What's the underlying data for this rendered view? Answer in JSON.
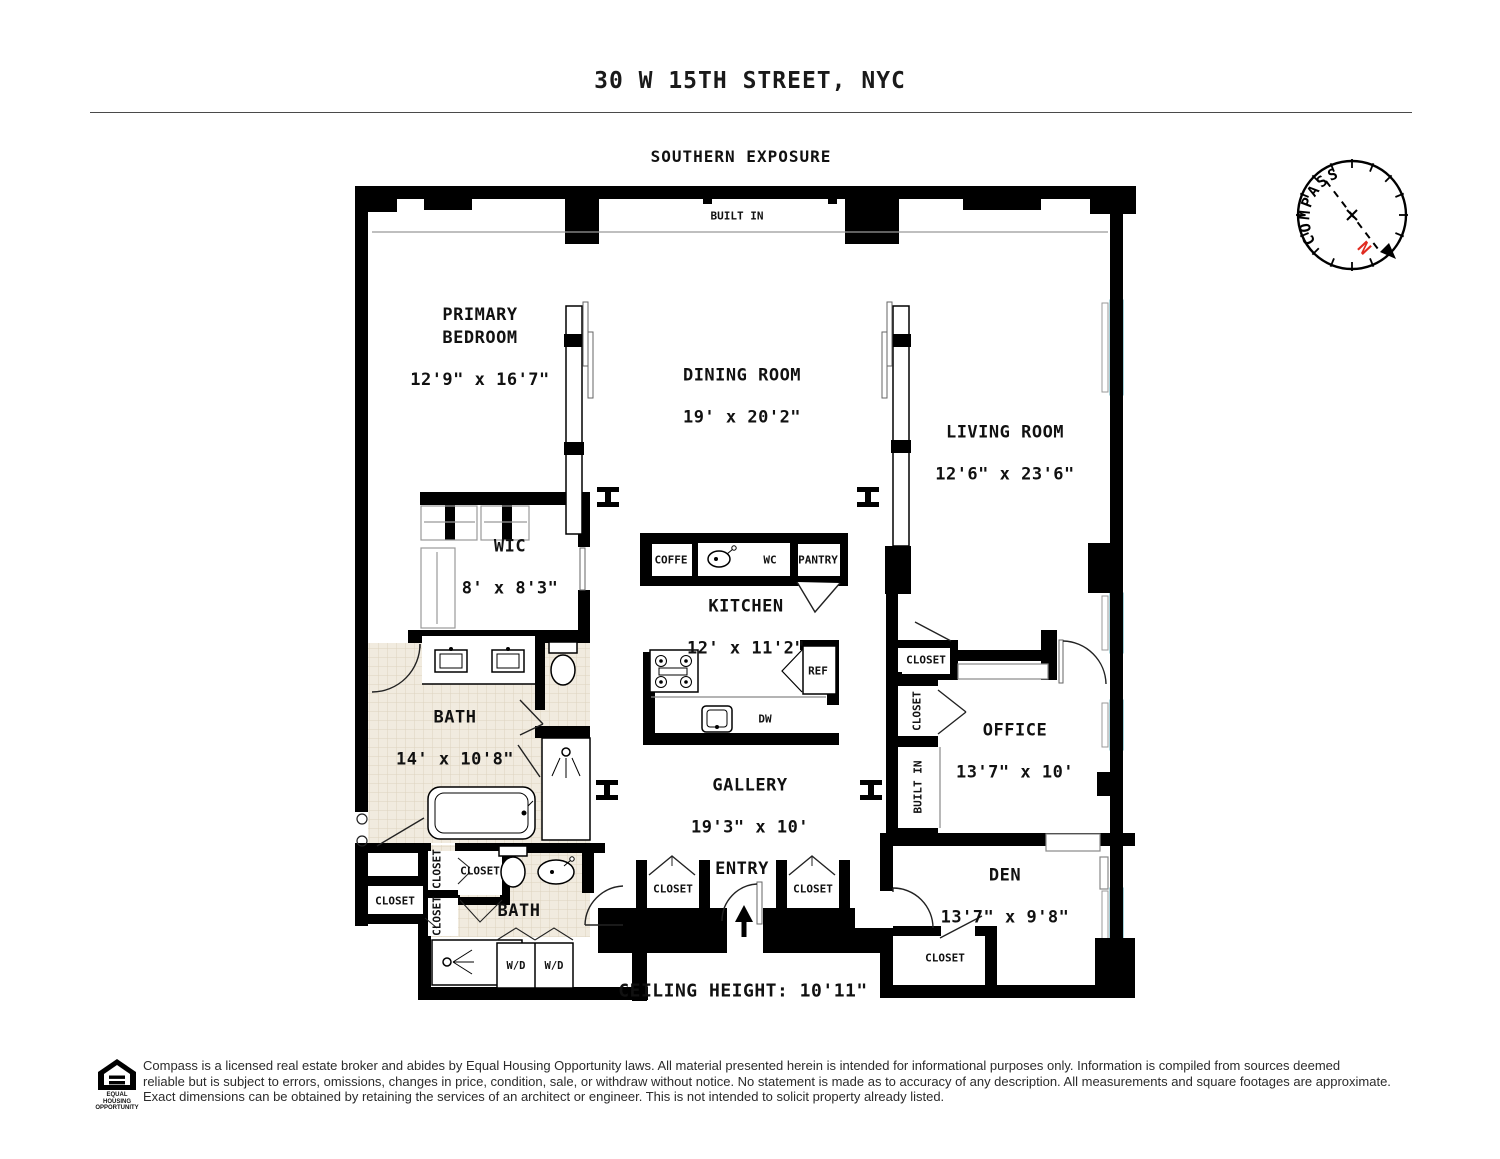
{
  "header": {
    "title": "30 W 15TH STREET, NYC",
    "exposure": "SOUTHERN EXPOSURE"
  },
  "compass": {
    "label": "COMPASS",
    "north": "N"
  },
  "colors": {
    "wall": "#000000",
    "window": "#8ed1da",
    "tile": "#f1ebdf",
    "north_red": "#e02b20"
  },
  "rooms": {
    "primary_bedroom": {
      "name": "PRIMARY\nBEDROOM",
      "dims": "12'9\" x 16'7\""
    },
    "dining": {
      "name": "DINING ROOM",
      "dims": "19' x 20'2\""
    },
    "living": {
      "name": "LIVING ROOM",
      "dims": "12'6\" x 23'6\""
    },
    "wic": {
      "name": "WIC",
      "dims": "8' x 8'3\""
    },
    "kitchen": {
      "name": "KITCHEN",
      "dims": "12' x 11'2\""
    },
    "bath": {
      "name": "BATH",
      "dims": "14' x 10'8\""
    },
    "gallery": {
      "name": "GALLERY",
      "dims": "19'3\" x 10'"
    },
    "office": {
      "name": "OFFICE",
      "dims": "13'7\" x 10'"
    },
    "den": {
      "name": "DEN",
      "dims": "13'7\" x 9'8\""
    },
    "bath2": {
      "name": "BATH"
    },
    "entry": {
      "name": "ENTRY"
    }
  },
  "labels": {
    "built_in": "BUILT IN",
    "closet": "CLOSET",
    "coffee": "COFFE",
    "wc": "WC",
    "pantry": "PANTRY",
    "ref": "REF",
    "dw": "DW",
    "wd": "W/D"
  },
  "notes": {
    "ceiling": "CEILING HEIGHT: 10'11\""
  },
  "footer": {
    "eho": "EQUAL HOUSING\nOPPORTUNITY",
    "lines": [
      "Compass is a licensed real estate broker and abides by Equal Housing Opportunity laws. All material presented herein is intended for informational purposes only. Information is compiled from sources deemed",
      "reliable but is subject to errors, omissions, changes in price, condition, sale, or withdraw without notice. No statement is made as to accuracy of any description. All measurements and square footages are approximate.",
      "Exact dimensions can be obtained by retaining the services of an architect or engineer. This is not intended to solicit property already listed."
    ]
  }
}
